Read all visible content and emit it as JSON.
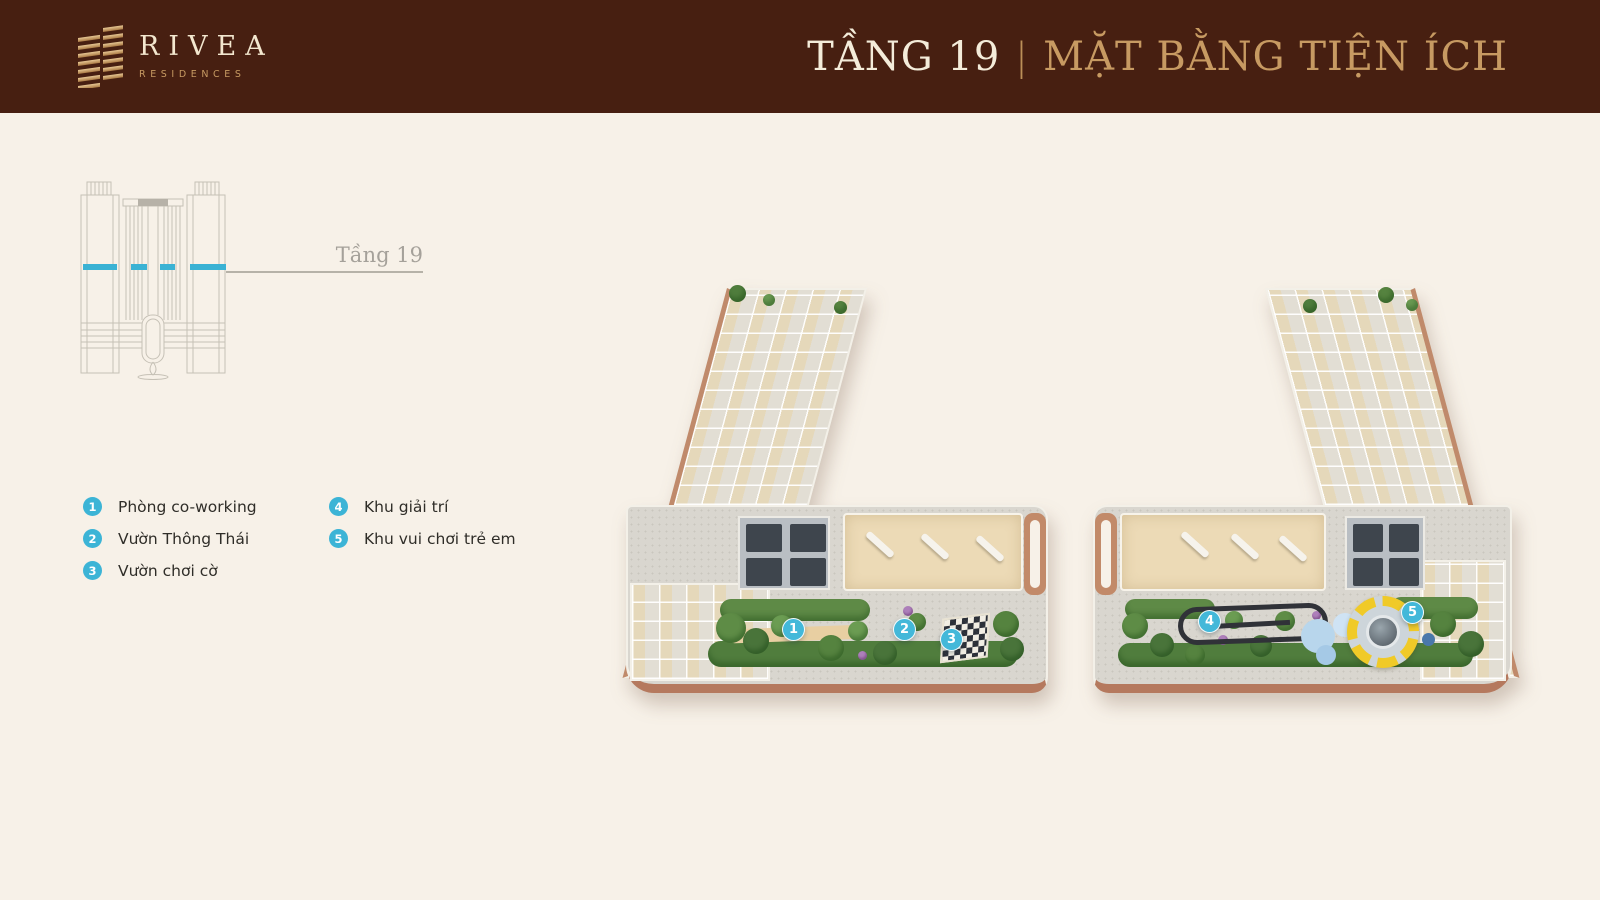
{
  "header": {
    "brand": {
      "name": "RIVEA",
      "tagline": "RESIDENCES"
    },
    "title": {
      "floor": "TẦNG 19",
      "divider": "|",
      "subtitle": "MẶT BẰNG TIỆN ÍCH"
    }
  },
  "elevation": {
    "floor_label": "Tầng 19"
  },
  "legend": {
    "items": [
      {
        "num": "1",
        "label": "Phòng co-working"
      },
      {
        "num": "2",
        "label": "Vườn Thông Thái"
      },
      {
        "num": "3",
        "label": "Vườn chơi cờ"
      },
      {
        "num": "4",
        "label": "Khu giải trí"
      },
      {
        "num": "5",
        "label": "Khu vui chơi trẻ em"
      }
    ]
  },
  "colors": {
    "header_bg": "#471f11",
    "gold": "#c79a62",
    "cream_text": "#f3e7cf",
    "accent_cyan": "#3cb4d6",
    "background": "#f7f1e8",
    "terracotta": "#bd8264"
  }
}
